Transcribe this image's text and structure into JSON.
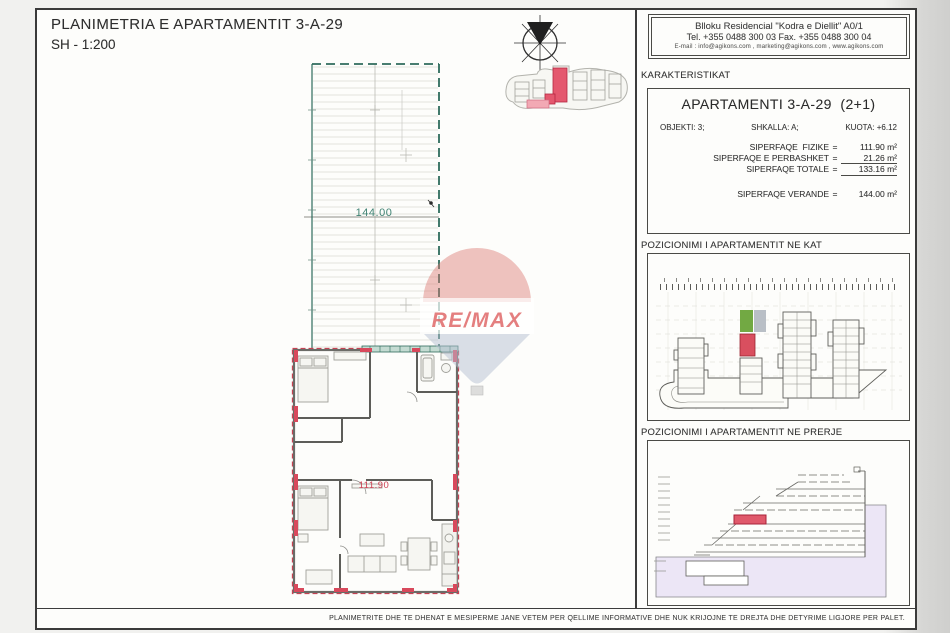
{
  "document": {
    "title": "PLANIMETRIA E APARTAMENTIT 3-A-29",
    "scale": "SH - 1:200"
  },
  "contact_header": {
    "line1": "Blloku Residencial \"Kodra e Diellit\" A0/1",
    "line2": "Tel. +355 0488 300 03   Fax. +355 0488 300 04",
    "line3": "E-mail : info@agikons.com , marketing@agikons.com , www.agikons.com"
  },
  "characteristics": {
    "section_title": "KARAKTERISTIKAT",
    "apartment_title": "APARTAMENTI 3-A-29  (2+1)",
    "objekti": "OBJEKTI: 3;",
    "shkalla": "SHKALLA: A;",
    "kuota": "KUOTA: +6.12",
    "eq": "=",
    "areas": [
      {
        "label": "SIPERFAQE  FIZIKE",
        "value": "111.90 m²"
      },
      {
        "label": "SIPERFAQE E PERBASHKET",
        "value": "21.26 m²"
      },
      {
        "label": "SIPERFAQE TOTALE",
        "value": "133.16 m²"
      },
      {
        "label": "SIPERFAQE VERANDE",
        "value": "144.00 m²"
      }
    ]
  },
  "positions": {
    "kat_title": "POZICIONIMI I APARTAMENTIT NE KAT",
    "prerje_title": "POZICIONIMI I APARTAMENTIT NE PRERJE"
  },
  "plan": {
    "veranda_area_label": "144.00",
    "apartment_area_label": "111.90",
    "watermark_text": "RE/MAX"
  },
  "footer": {
    "disclaimer": "PLANIMETRITE DHE TE DHENAT E MESIPERME JANE VETEM PER QELLIME INFORMATIVE DHE NUK KRIJOJNE TE DREJTA DHE DETYRIME LIGJORE PER PALET."
  },
  "colors": {
    "veranda_outline": "#2e6b5c",
    "highlight_red": "#d8495c",
    "highlight_green": "#72a943",
    "section_ground": "#ece6f6",
    "watermark_red": "#dd5f5f",
    "watermark_blue": "#b6bfd2"
  }
}
